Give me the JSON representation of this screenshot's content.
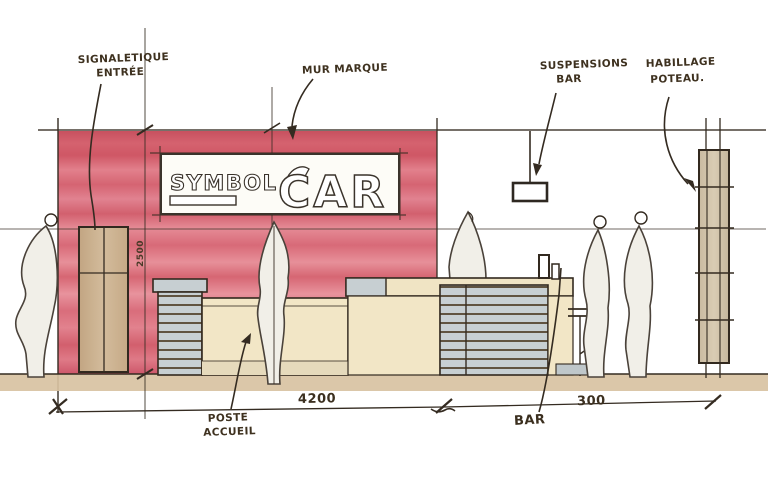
{
  "logo": {
    "top": "SYMBOL",
    "main": "CAR"
  },
  "annotations": {
    "entrance_signage": {
      "line1": "SIGNALETIQUE",
      "line2": "ENTRÉE"
    },
    "brand_wall": "MUR MARQUE",
    "bar_suspensions": {
      "line1": "SUSPENSIONS",
      "line2": "BAR"
    },
    "column_cladding": {
      "line1": "HABILLAGE",
      "line2": "POTEAU."
    },
    "reception_desk": {
      "line1": "POSTE",
      "line2": "ACCUEIL"
    },
    "bar": "BAR"
  },
  "dimensions": {
    "overall_width": "4200",
    "right_section_width": "300",
    "wall_height": "2500"
  },
  "colors": {
    "brand_wall_red": "#dd7280",
    "wood_tan": "#cbb190",
    "counter_cream": "#f2e6c6",
    "slat_gray": "#c7cfd2",
    "ink": "#3b3227"
  }
}
